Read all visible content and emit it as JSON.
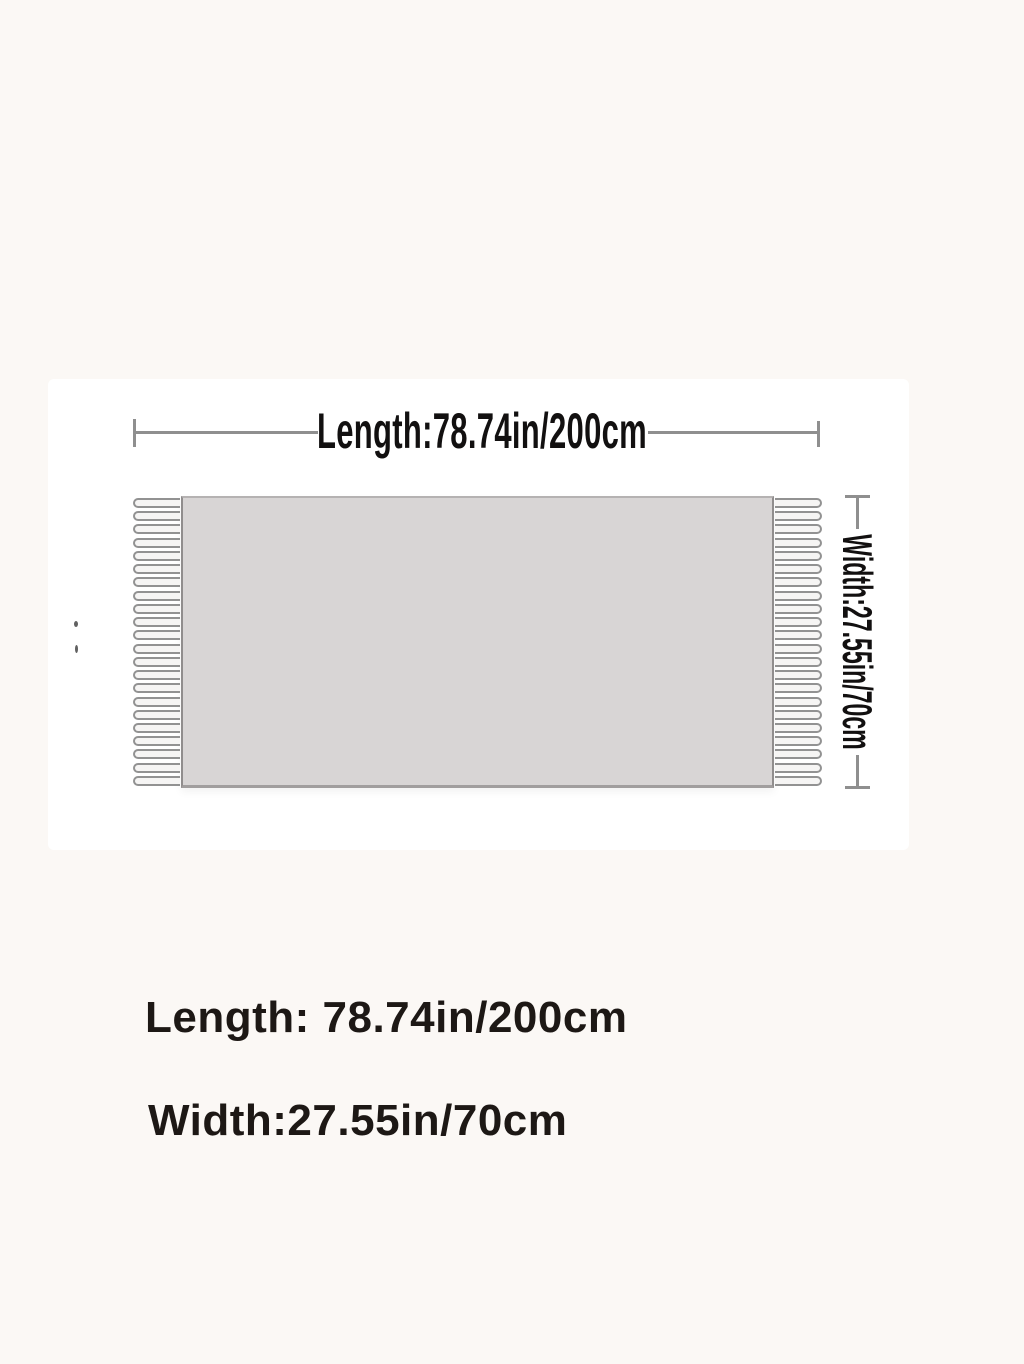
{
  "colors": {
    "page_bg": "#fbf8f5",
    "panel_bg": "#ffffff",
    "scarf_fill": "#d8d5d5",
    "scarf_edge": "#908d8d",
    "fringe_outline": "#929292",
    "dim_line": "#8f8f8f",
    "text": "#1d1815"
  },
  "diagram": {
    "length_dimension_label": "Length:78.74in/200cm",
    "width_dimension_label": "Width:27.55in/70cm",
    "fringe_tassels_per_side": 22
  },
  "specs": {
    "length_line": "Length: 78.74in/200cm",
    "width_line": "Width:27.55in/70cm"
  }
}
